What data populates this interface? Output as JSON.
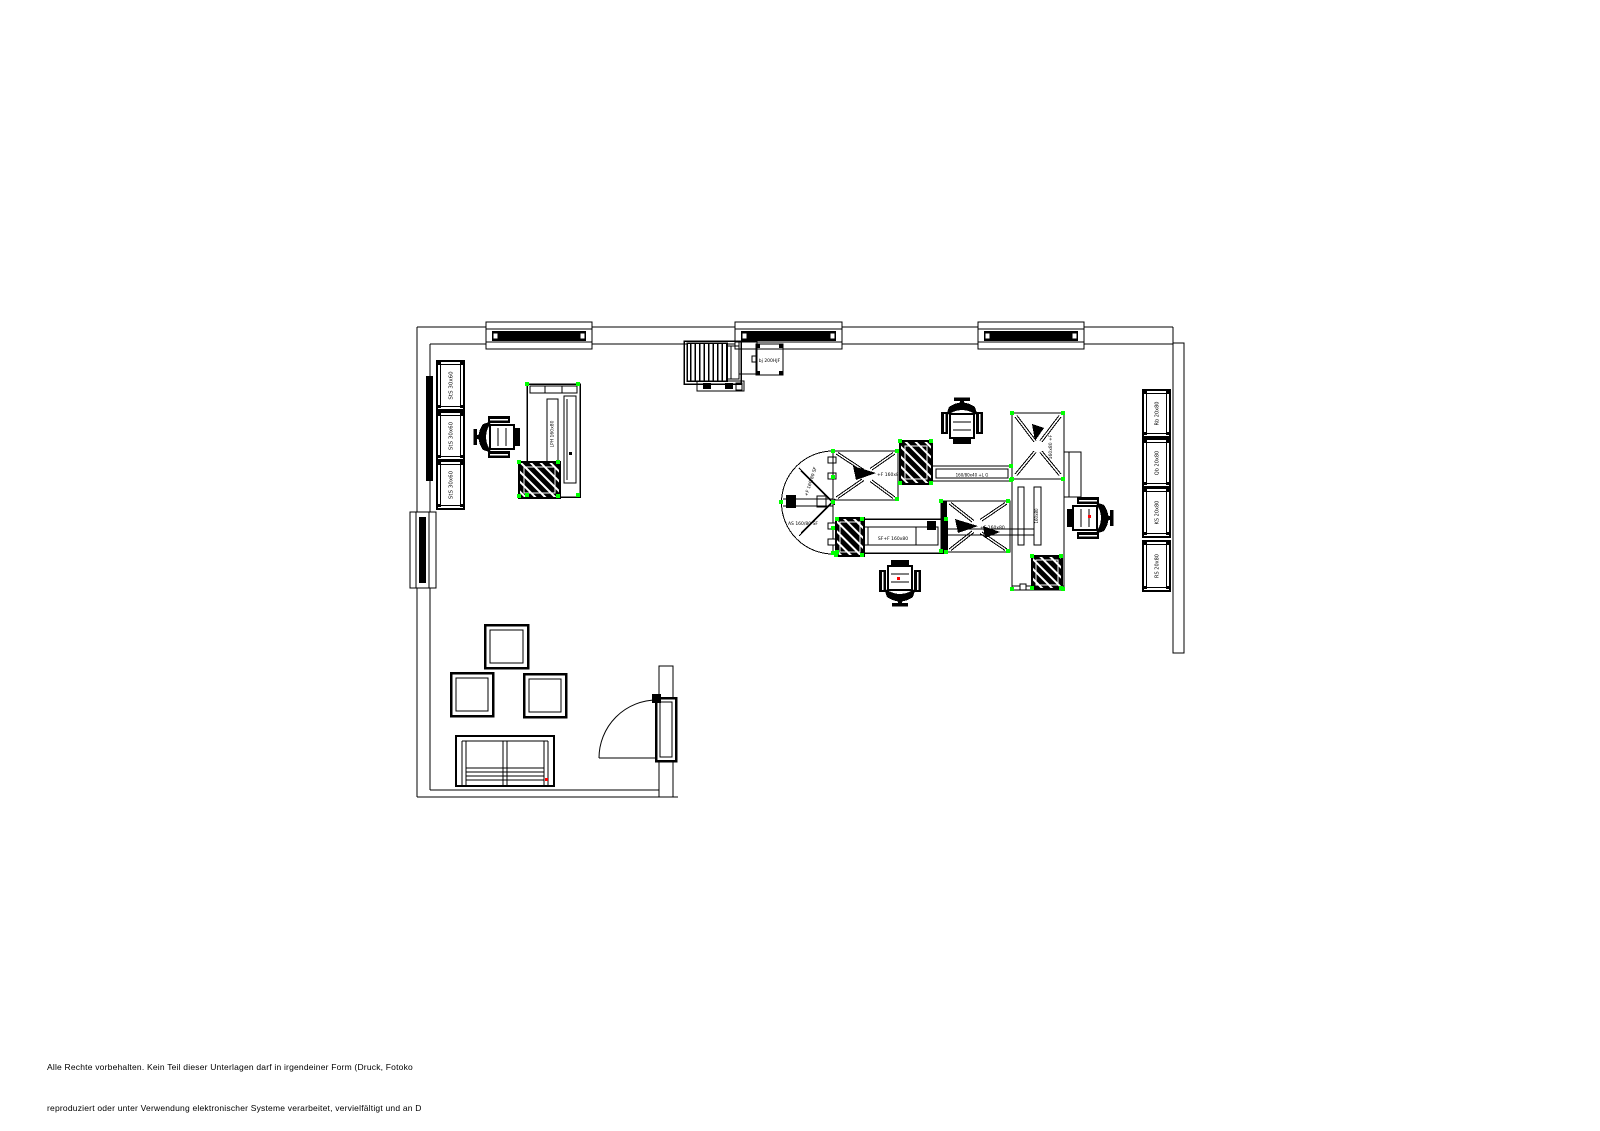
{
  "footer": {
    "line1": "Alle Rechte vorbehalten. Kein Teil dieser Unterlagen darf in irgendeiner Form (Druck, Fotoko",
    "line2": "reproduziert oder unter Verwendung elektronischer Systeme verarbeitet, vervielfältigt und an D"
  },
  "plan": {
    "left_cabinets": {
      "c1": "StS 30x60",
      "c2": "StS 30x60",
      "c3": "StS 30x60"
    },
    "right_cabinets": {
      "c1": "Rb 20x80",
      "c2": "Qb 20x80",
      "c3": "KS 20x80",
      "c4": "RS 20x80"
    },
    "device_label": "bj 200HJF",
    "workstation_label": "LPH 160x80",
    "disc_label_upper": "+F 160/80 SF",
    "disc_label_lower": "AS 160/80 SF",
    "desk_a_label": "+F 160x80",
    "link_label": "160/80x40 +L G",
    "desk_b_label": "SF+F 160x80",
    "desk_c_label": "+F 160x80",
    "desk_d_label": "160x80 +F",
    "return_label": "160x80"
  },
  "colors": {
    "line": "#000000",
    "grip": "#00ff00",
    "marker": "#ff0000",
    "background": "#ffffff"
  }
}
